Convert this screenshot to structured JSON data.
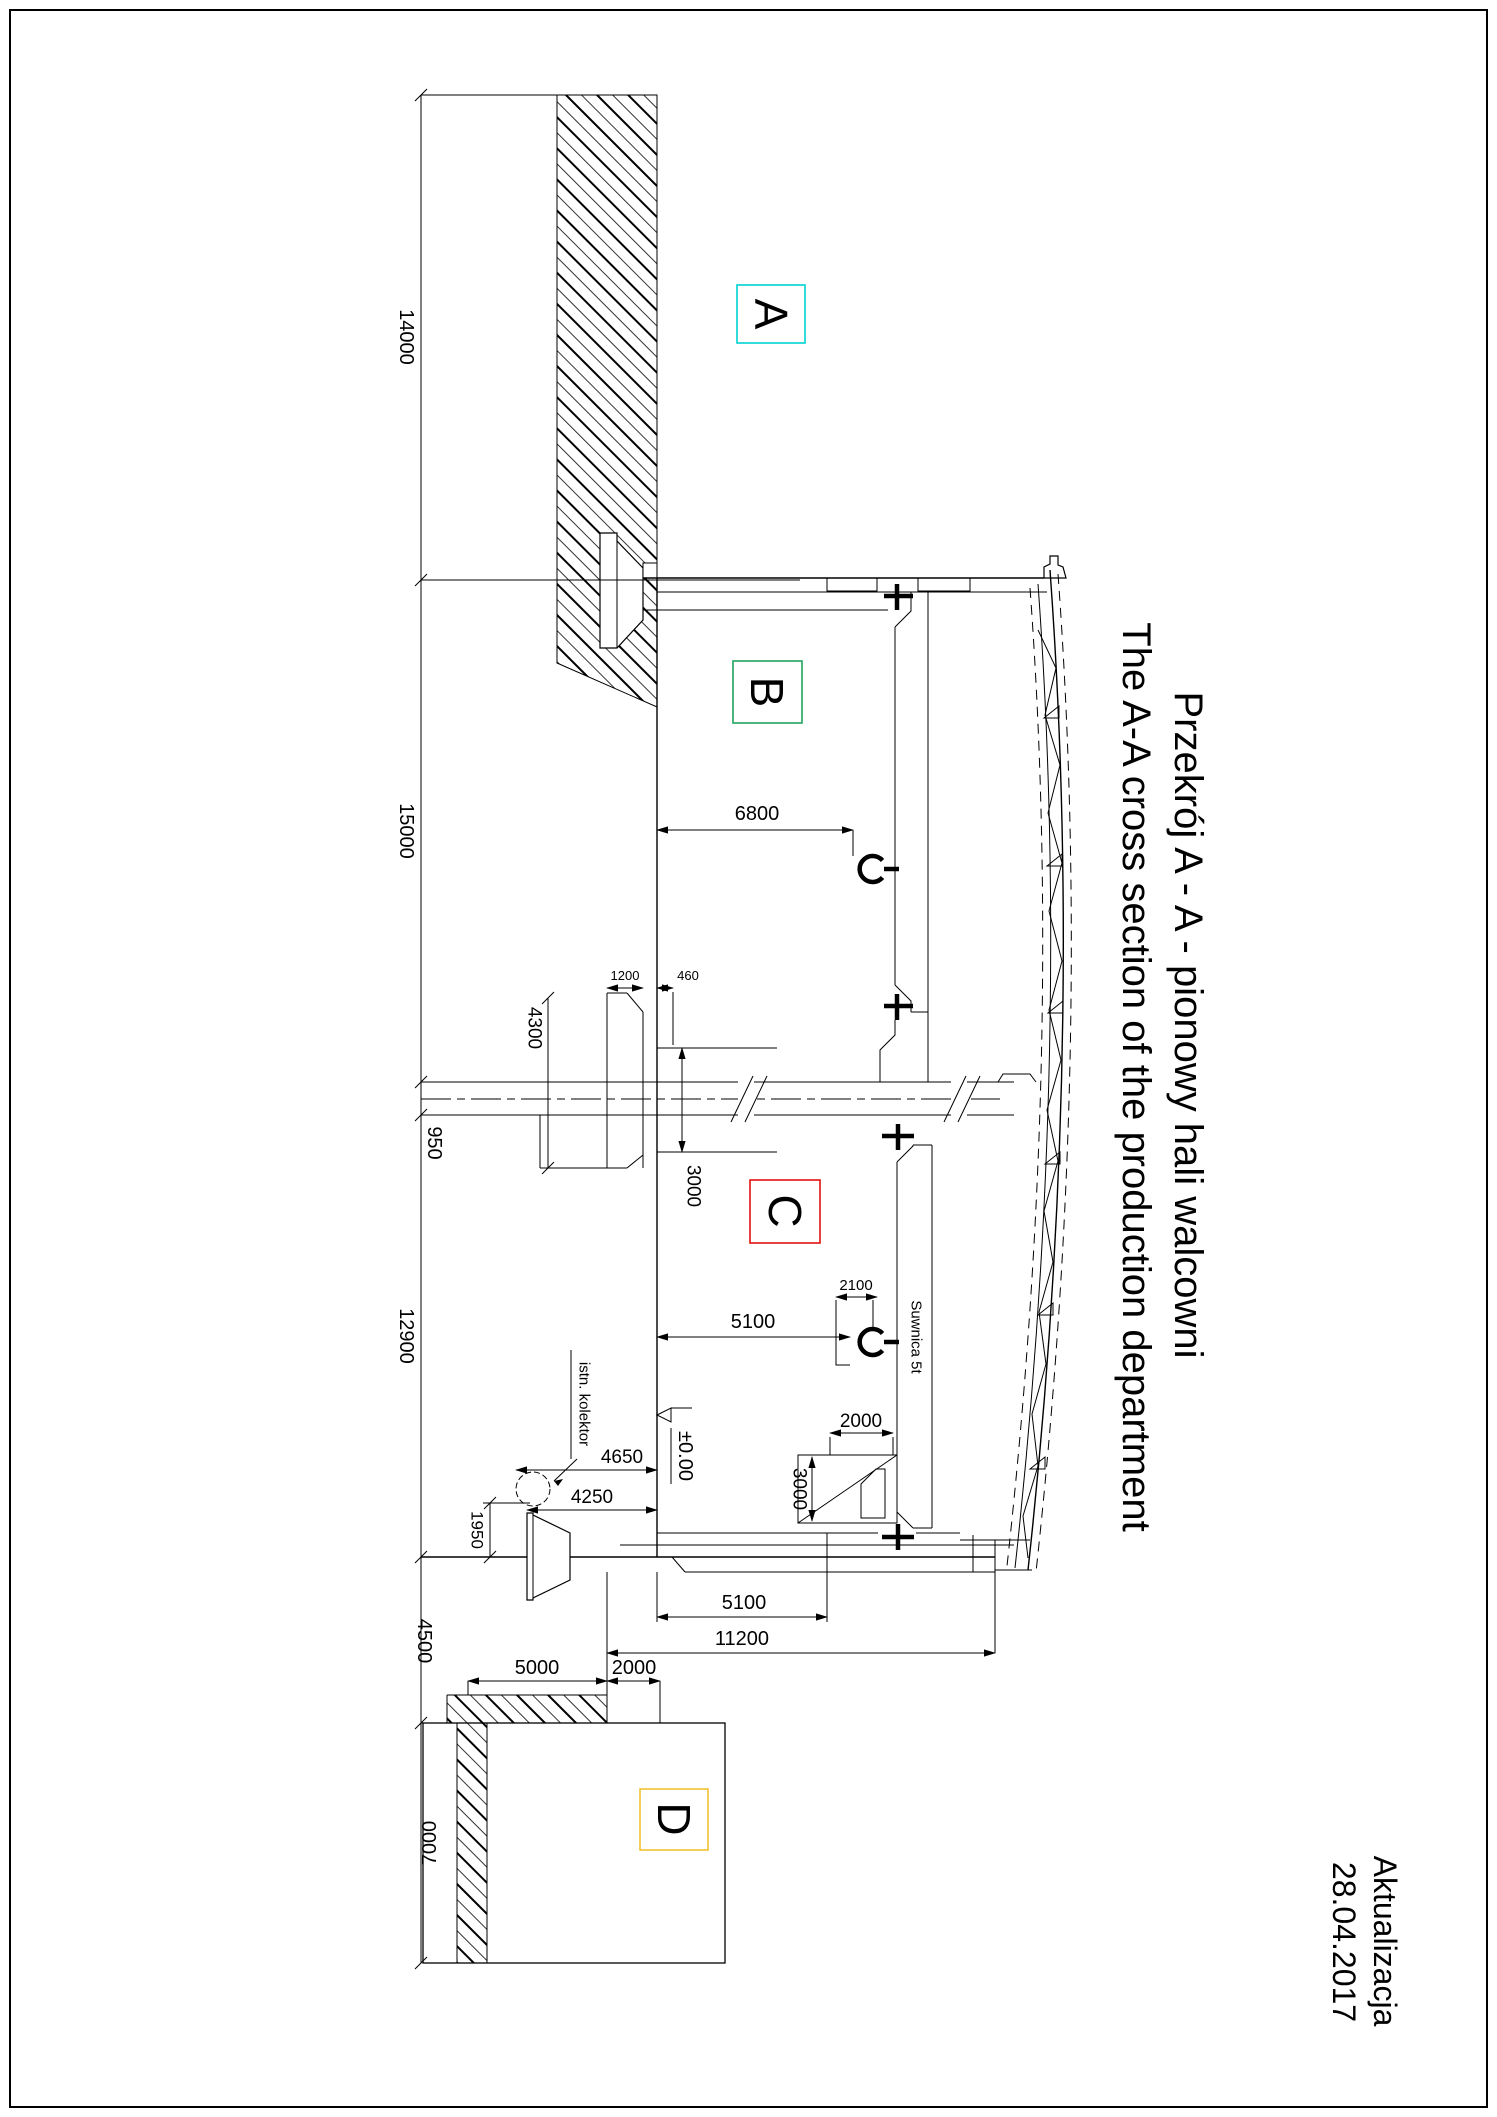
{
  "drawing": {
    "title_pl": "Przekrój A - A - pionowy hali walcowni",
    "title_en": "The A-A cross section of the production department",
    "update_label": "Aktualizacja",
    "update_date": "28.04.2017"
  },
  "zones": {
    "a": {
      "label": "A",
      "color": "#00d2d2"
    },
    "b": {
      "label": "B",
      "color": "#1fa35c"
    },
    "c": {
      "label": "C",
      "color": "#e01212"
    },
    "d": {
      "label": "D",
      "color": "#f0c232"
    }
  },
  "dims": {
    "chain_14000": "14000",
    "chain_15000": "15000",
    "chain_950": "950",
    "chain_12900": "12900",
    "chain_4500": "4500",
    "chain_7000": "7000",
    "hook_b": "6800",
    "col_1200": "1200",
    "col_460": "460",
    "col_4300": "4300",
    "rail_3000": "3000",
    "hook_c": "5100",
    "trolley_2100": "2100",
    "trolley_2000": "2000",
    "trolley_3000": "3000",
    "f_4650": "4650",
    "f_4250": "4250",
    "f_1950": "1950",
    "bot_5100": "5100",
    "bot_11200": "11200",
    "bot_5000": "5000",
    "bot_2000": "2000"
  },
  "annotations": {
    "kolektor": "istn. kolektor",
    "crane": "Suwnica 5t",
    "level": "±0.00"
  }
}
